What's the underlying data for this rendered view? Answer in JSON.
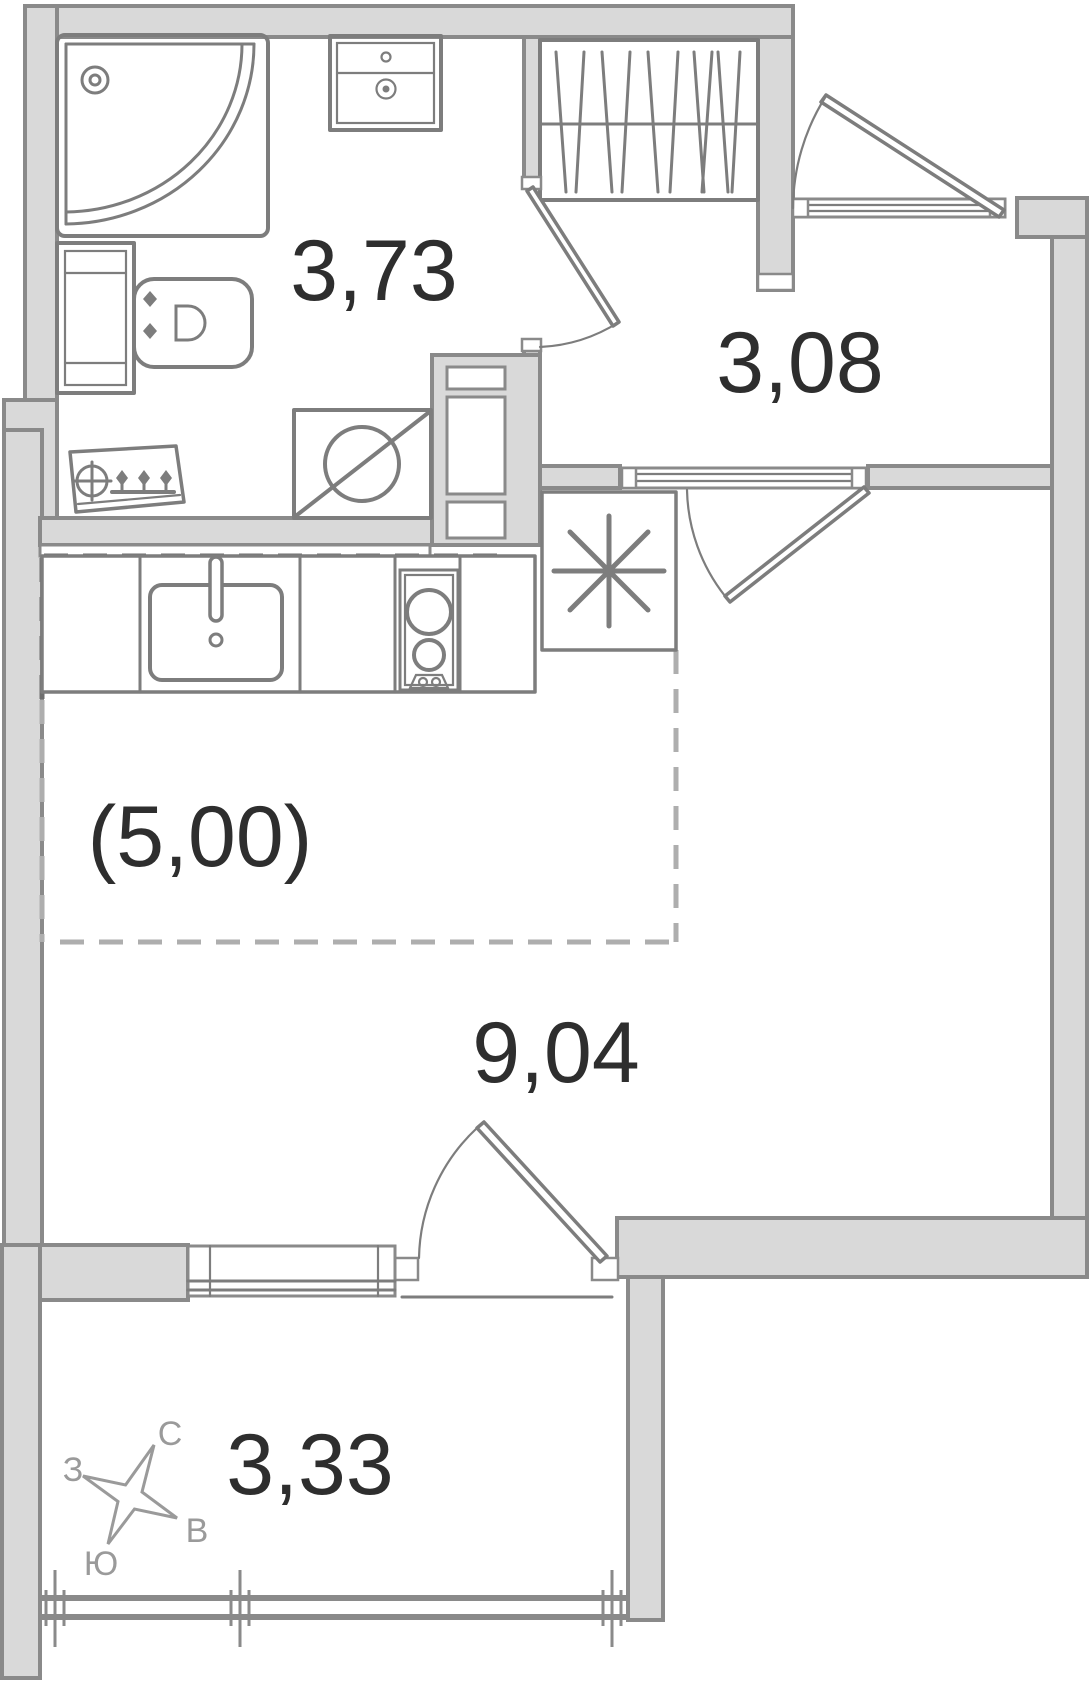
{
  "plan": {
    "type": "apartment-floor-plan",
    "rooms": [
      {
        "name": "bathroom",
        "area": "3,73"
      },
      {
        "name": "hallway",
        "area": "3,08"
      },
      {
        "name": "kitchen-zone",
        "area": "(5,00)"
      },
      {
        "name": "living-room",
        "area": "9,04"
      },
      {
        "name": "balcony",
        "area": "3,33"
      }
    ],
    "compass": {
      "n": "С",
      "w": "З",
      "e": "В",
      "s": "Ю"
    },
    "colors": {
      "background": "#ffffff",
      "wall_fill": "#d9d9d9",
      "wall_stroke": "#8a8a8a",
      "fixture_stroke": "#7d7d7d",
      "label": "#2e2e2e",
      "compass": "#9a9a9a",
      "dash_dark": "#6e6e6e",
      "dash_light": "#aeaeae"
    }
  }
}
